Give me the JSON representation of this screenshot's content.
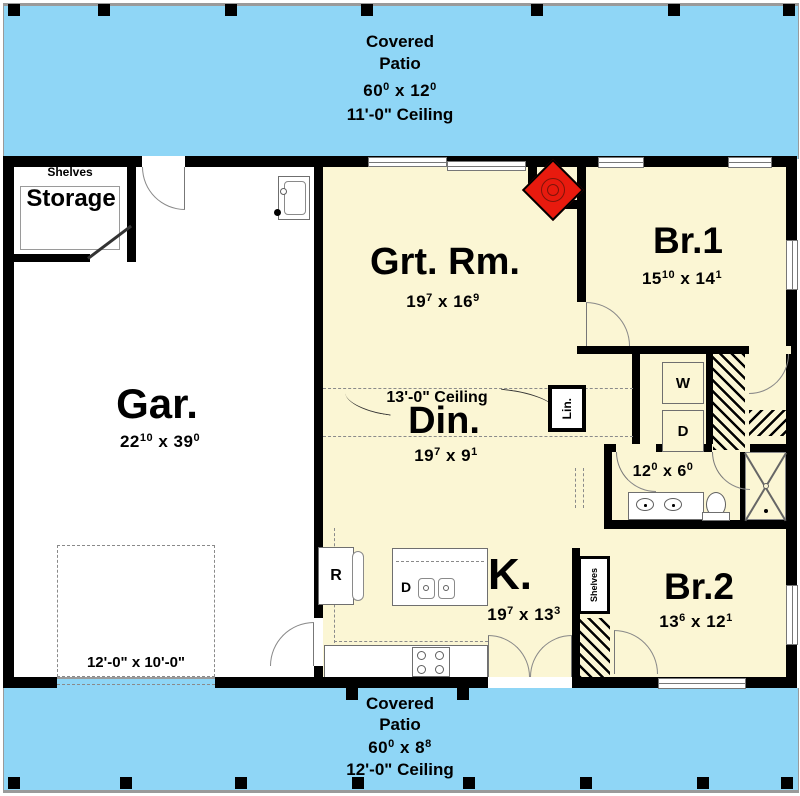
{
  "colors": {
    "patio_blue": "#8fd6f6",
    "floor_yellow": "#fbf6d4",
    "wall_black": "#000000",
    "fireplace_red": "#e81a0e"
  },
  "patio_top": {
    "line1": "Covered",
    "line2": "Patio",
    "dim": [
      {
        "t": "60"
      },
      {
        "t": "0",
        "sup": true
      },
      {
        "t": " x "
      },
      {
        "t": "12"
      },
      {
        "t": "0",
        "sup": true
      }
    ],
    "ceiling": "11'-0\" Ceiling"
  },
  "patio_bottom": {
    "line1": "Covered",
    "line2": "Patio",
    "dim": [
      {
        "t": "60"
      },
      {
        "t": "0",
        "sup": true
      },
      {
        "t": " x "
      },
      {
        "t": "8"
      },
      {
        "t": "8",
        "sup": true
      }
    ],
    "ceiling": "12'-0\" Ceiling"
  },
  "garage": {
    "label": "Gar.",
    "dim": [
      {
        "t": "22"
      },
      {
        "t": "10",
        "sup": true
      },
      {
        "t": " x "
      },
      {
        "t": "39"
      },
      {
        "t": "0",
        "sup": true
      }
    ],
    "door_label": "12'-0\" x 10'-0\""
  },
  "storage": {
    "label": "Storage",
    "shelves_label": "Shelves"
  },
  "great_room": {
    "label": "Grt. Rm.",
    "dim": [
      {
        "t": "19"
      },
      {
        "t": "7",
        "sup": true
      },
      {
        "t": " x "
      },
      {
        "t": "16"
      },
      {
        "t": "9",
        "sup": true
      }
    ]
  },
  "dining": {
    "label": "Din.",
    "dim": [
      {
        "t": "19"
      },
      {
        "t": "7",
        "sup": true
      },
      {
        "t": " x "
      },
      {
        "t": "9"
      },
      {
        "t": "1",
        "sup": true
      }
    ],
    "ceiling_note": "13'-0\" Ceiling"
  },
  "kitchen": {
    "label": "K.",
    "dim": [
      {
        "t": "19"
      },
      {
        "t": "7",
        "sup": true
      },
      {
        "t": " x "
      },
      {
        "t": "13"
      },
      {
        "t": "3",
        "sup": true
      }
    ],
    "fridge_label": "R",
    "dishwasher_label": "D"
  },
  "bedroom1": {
    "label": "Br.1",
    "dim": [
      {
        "t": "15"
      },
      {
        "t": "10",
        "sup": true
      },
      {
        "t": " x "
      },
      {
        "t": "14"
      },
      {
        "t": "1",
        "sup": true
      }
    ]
  },
  "bedroom2": {
    "label": "Br.2",
    "dim": [
      {
        "t": "13"
      },
      {
        "t": "6",
        "sup": true
      },
      {
        "t": " x "
      },
      {
        "t": "12"
      },
      {
        "t": "1",
        "sup": true
      }
    ],
    "shelves_label": "Shelves"
  },
  "bathroom": {
    "dim": [
      {
        "t": "12"
      },
      {
        "t": "0",
        "sup": true
      },
      {
        "t": " x "
      },
      {
        "t": "6"
      },
      {
        "t": "0",
        "sup": true
      }
    ]
  },
  "laundry": {
    "washer_label": "W",
    "dryer_label": "D"
  },
  "linen": {
    "label": "Lin."
  }
}
